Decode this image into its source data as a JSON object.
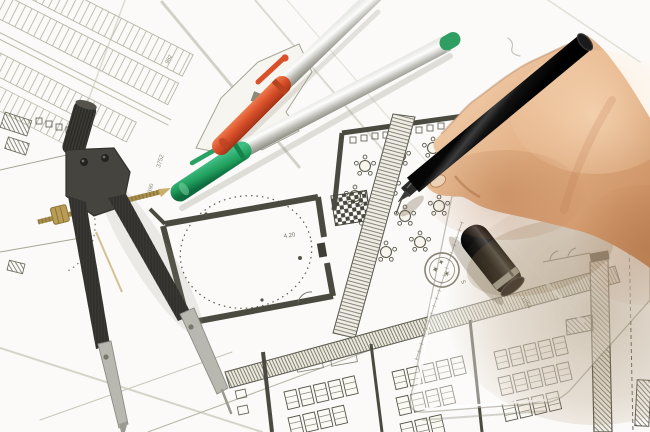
{
  "scene": {
    "description": "architect hand drawing with black pen on blueprints",
    "labels": {
      "dim_3752": "3752",
      "dim_390": "390",
      "dim_982": "982",
      "dim_1254": "1254",
      "level": "4.20",
      "scale_6": "6",
      "scale_5": "5",
      "stamp_glyph_a": "✦",
      "stamp_glyph_b": "✶",
      "stamp_glyph_c": "✦"
    },
    "objects": {
      "compass": "drafting-compass-divider",
      "pen_orange": "orange-capped-pen",
      "pen_green": "green-capped-pen",
      "black_pen": "black-fineliner-in-hand",
      "pen_cap": "black-pen-cap",
      "set_square": "translucent-set-square",
      "drawings": "architectural-floor-plans"
    },
    "colors": {
      "orange_cap": "#d9502a",
      "green_cap": "#1f9d5b",
      "brass": "#a98f4e",
      "skin": "#ddab80",
      "paper": "#fbfaf8",
      "plan_line": "#55544a"
    }
  }
}
